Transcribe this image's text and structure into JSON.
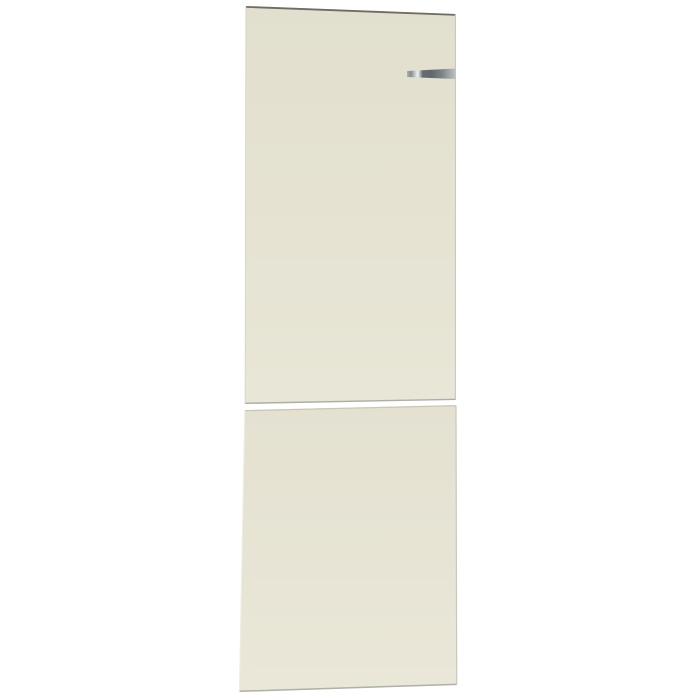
{
  "scene": {
    "description": "Product photo of a two-piece cream refrigerator door front panel set on a plain white background; tall upper panel with small metallic logo strip near its top-right edge, shorter lower panel below, separated by a thin white seam",
    "background_color": "#ffffff"
  },
  "panels": {
    "upper": {
      "top_color": "#e2dfce",
      "mid_color": "#e5e2d2",
      "bottom_color": "#e8e6d6"
    },
    "lower": {
      "top_color": "#e4e1d1",
      "bottom_color": "#eae7d8"
    }
  },
  "badge": {
    "name": "metallic-logo-strip",
    "colors": {
      "c0": "#aeb3b3",
      "c1": "#848c8f",
      "c2": "#c2c7c7",
      "c3": "#f1f3f3",
      "c4": "#646d71",
      "c5": "#5f686c",
      "c6": "#7d8589",
      "c7": "#a3aaac",
      "c8": "#c0c5c6"
    }
  },
  "edges": {
    "top_dark": "#6f6d5f",
    "seam_upper": "#aeaea6",
    "seam_lower": "#c9c6b7",
    "bottom": "#b0b0a8",
    "right": "#c8c8c1",
    "left_upper": "#d5d2c3",
    "left_lower": "#efede0"
  }
}
